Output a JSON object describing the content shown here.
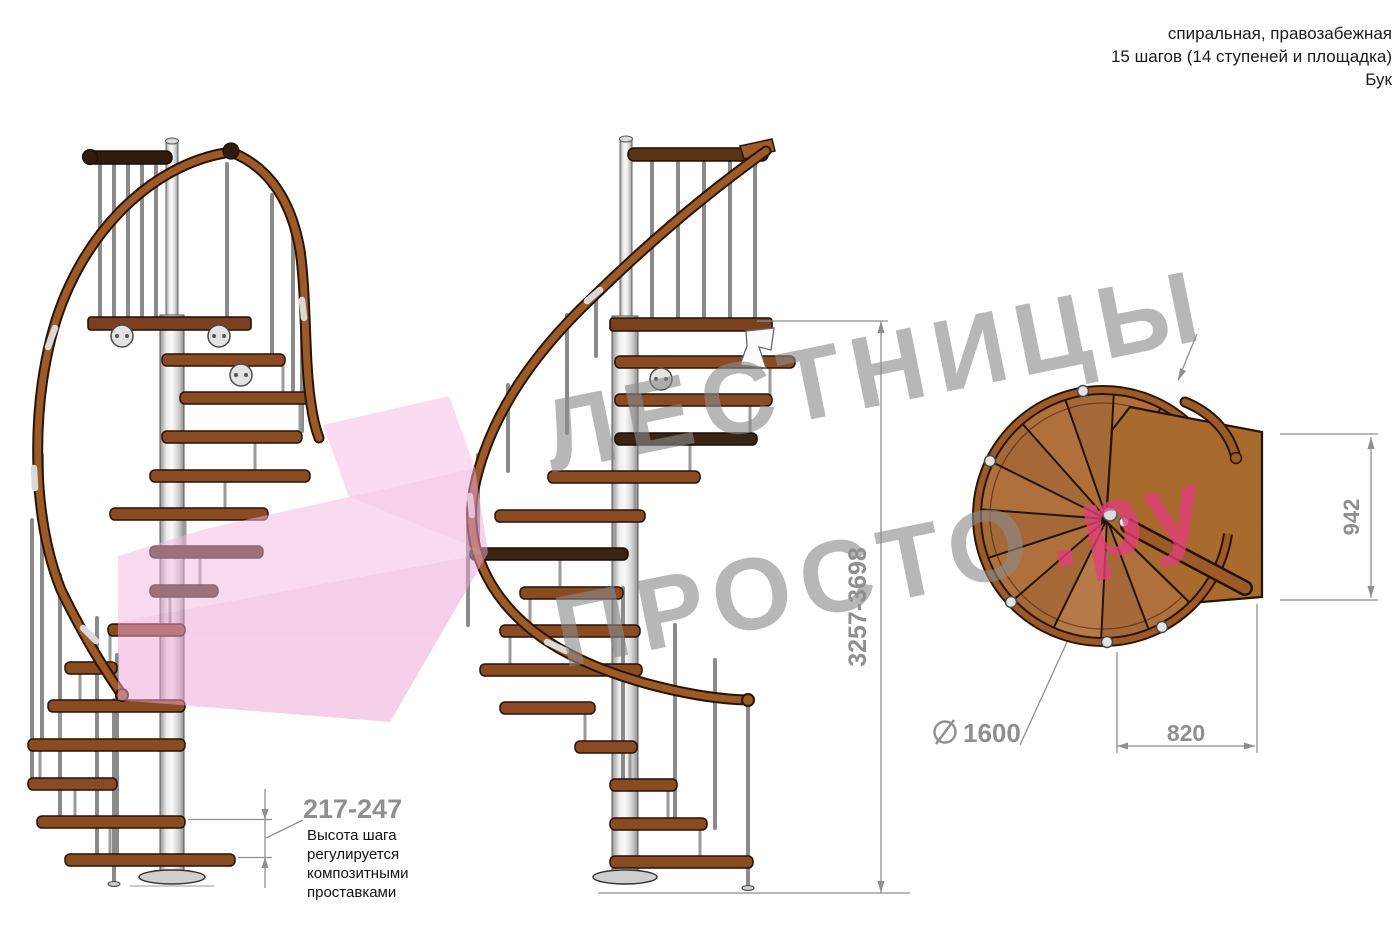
{
  "title_block": {
    "line1": "спиральная, правозабежная",
    "line2": "15 шагов (14 ступеней и площадка)",
    "line3": "Бук"
  },
  "watermark": {
    "word_top": "ЛЕСТНИЦЫ",
    "word_bottom": "ПРОСТО",
    "word_bottom_suffix": ".ру",
    "gray": "#8a8a8a",
    "pink": "#e23f7a"
  },
  "dimensions": {
    "step_height": {
      "value": "217-247",
      "note": "Высота шага\nрегулируется\nкомпозитными\nпроставками"
    },
    "total_height": {
      "value": "3257-3698"
    },
    "plan_landing_width": {
      "value": "942"
    },
    "plan_passage_width": {
      "value": "820"
    },
    "plan_diameter": {
      "value": "1600",
      "symbol": "diameter-icon"
    }
  },
  "colors": {
    "dimension_gray": "#8f8f8f",
    "wood_brown": "#8a4a22",
    "handrail_brown": "#9c5a28",
    "logo_pink": "#f0a6d6"
  }
}
